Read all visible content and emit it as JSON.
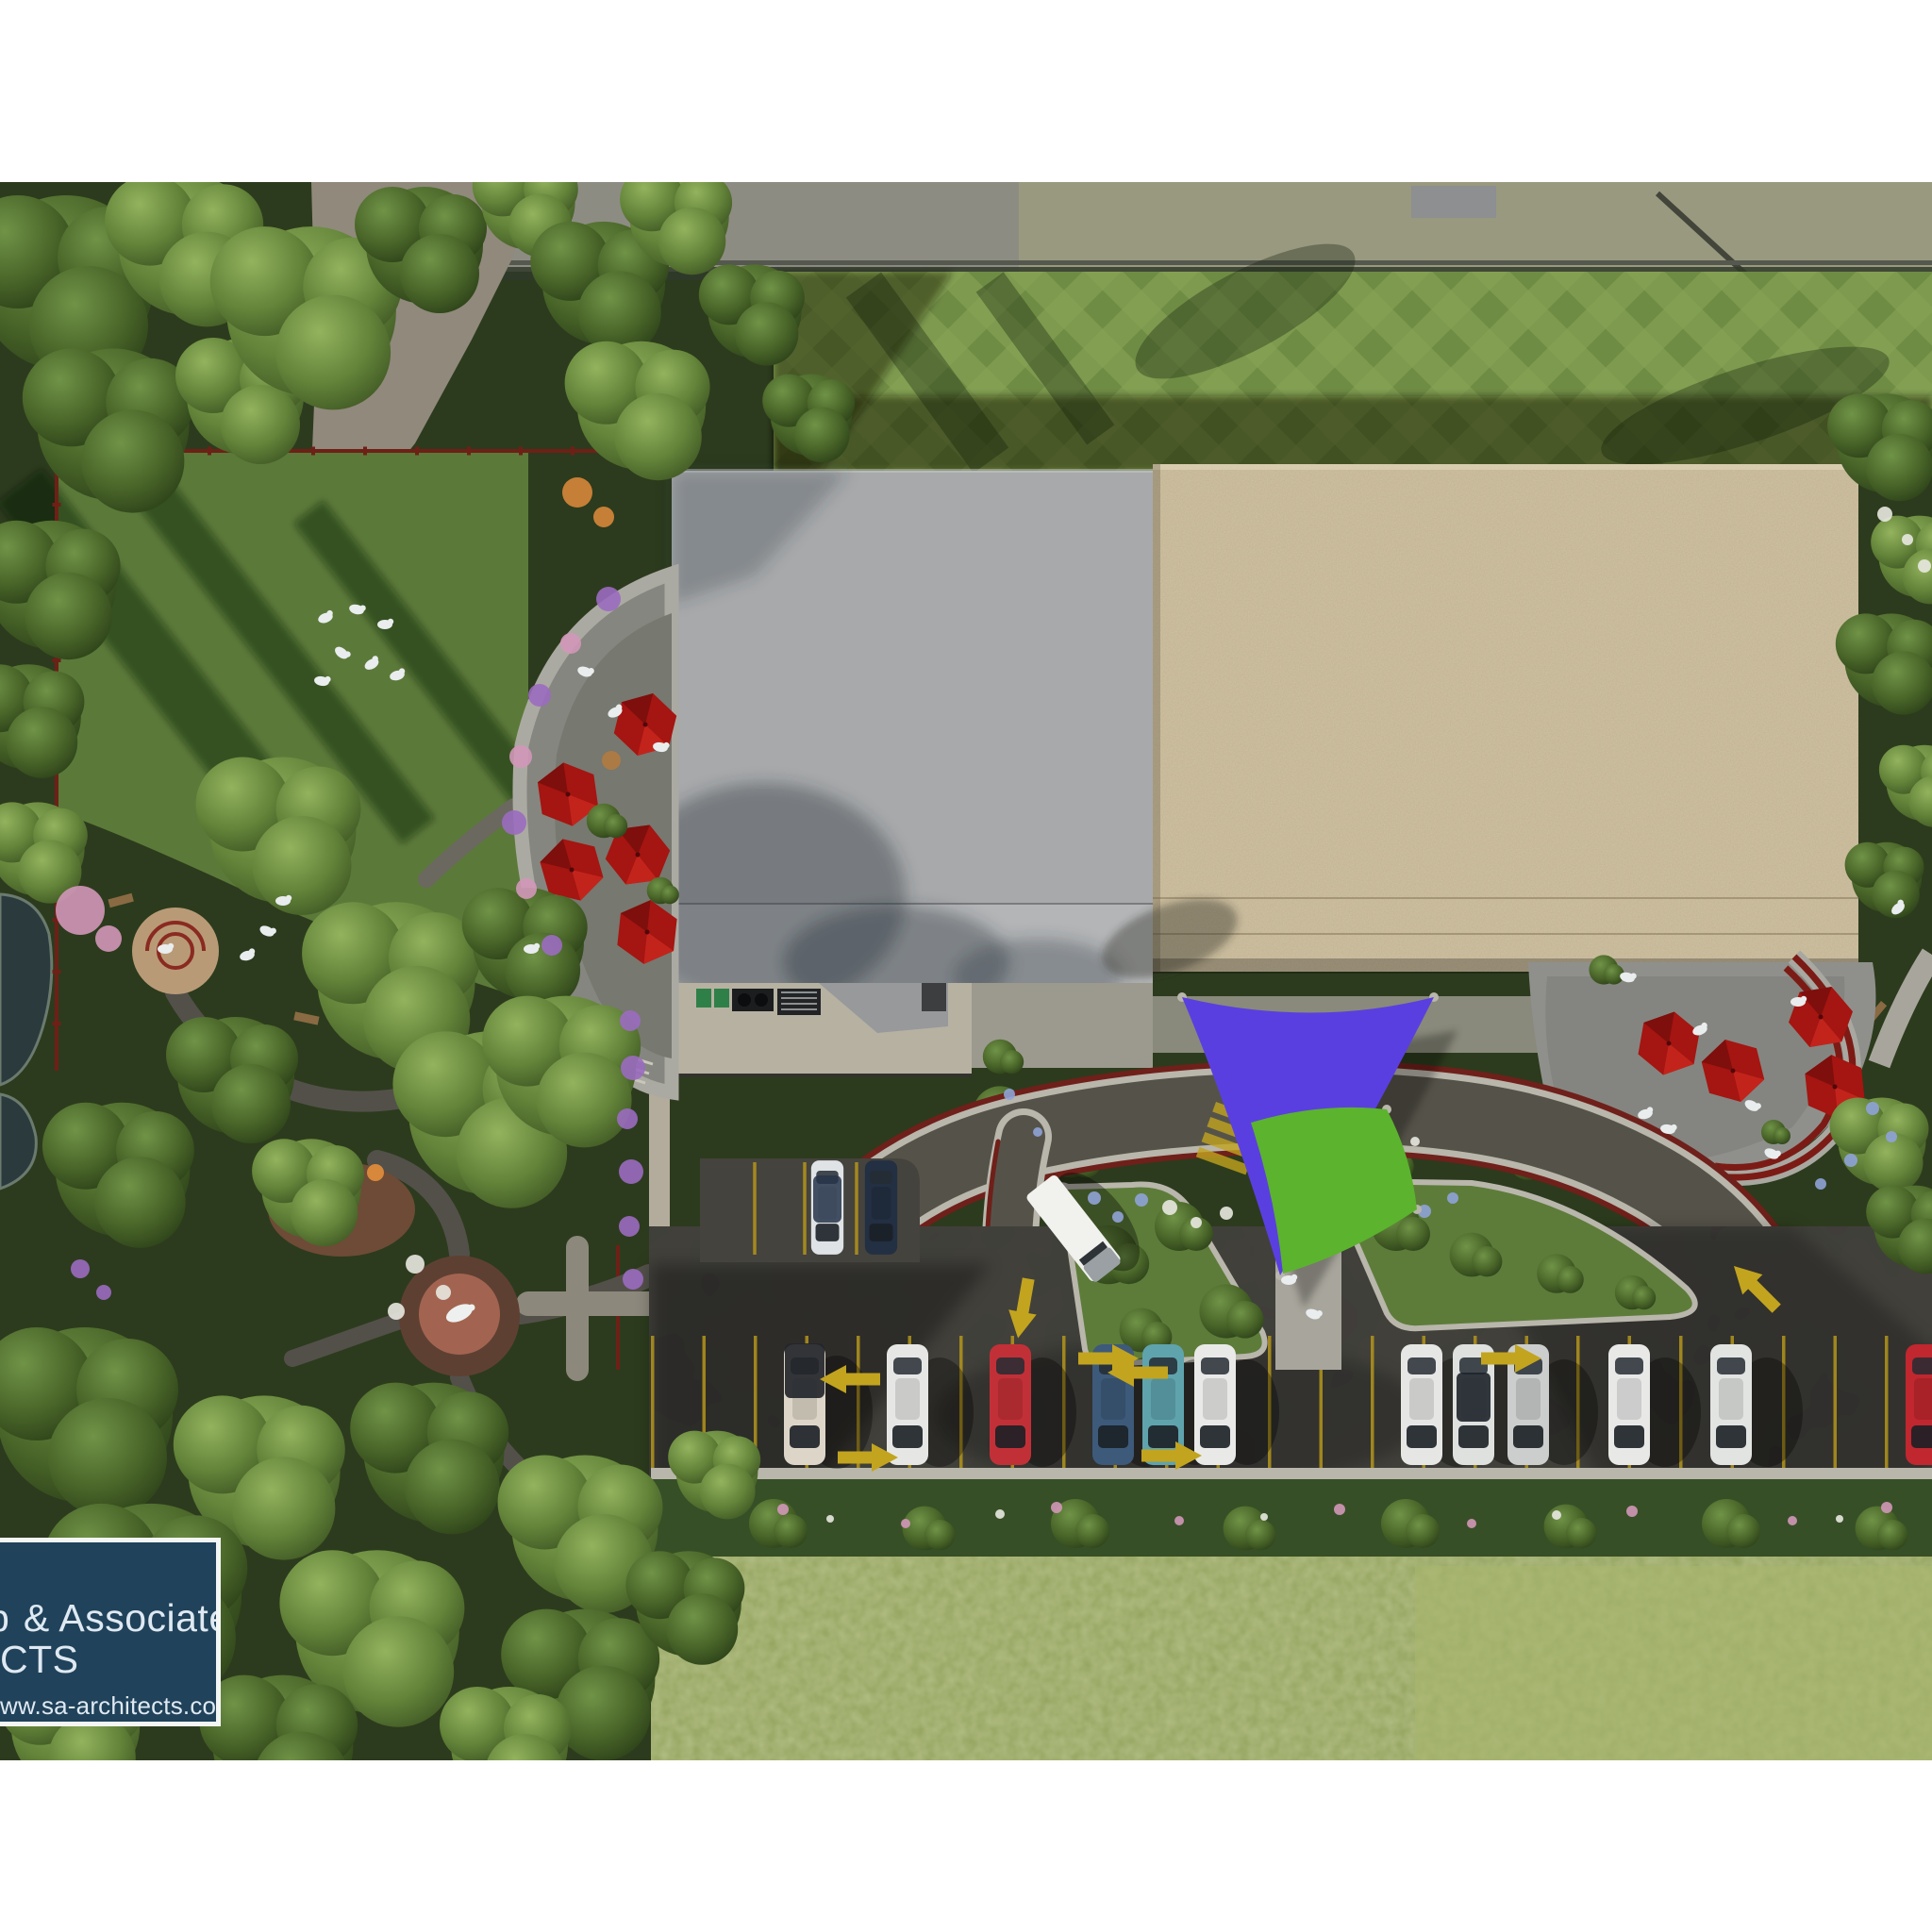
{
  "logo": {
    "line1_partial": "b",
    "line1": " & Associates",
    "line2": "CTS",
    "line3": "ww.sa-architects.com"
  },
  "colors": {
    "page_bg": "#ffffff",
    "forest_dark": "#2c3b1d",
    "lawn_green": "#5b7a39",
    "plaid_base": "#7d9a4e",
    "dirt": "#90897c",
    "top_road": "#8d8c83",
    "verge": "#9a9a7e",
    "roof_grey": "#a7a9ab",
    "roof_grey_light": "#b3b5b7",
    "roof_beige": "#cfc1a2",
    "service_pad": "#b7b1a2",
    "patio_light": "#8f908c",
    "patio_dark": "#77786f",
    "trellis_red": "#7c1b15",
    "umbrella_red": "#a51511",
    "asphalt": "#403e39",
    "road_asphalt": "#555349",
    "curb": "#b9b6ac",
    "curb_red": "#6f201a",
    "paint_yellow": "#c2a41f",
    "stall_yellow": "#b3951b",
    "island_grass": "#5d7c3a",
    "sail_purple": "#5a3fe0",
    "sail_green": "#5cb32e",
    "pond": "#2b3a3d",
    "sand": "#b99a77",
    "brick_outer": "#5e4033",
    "brick_inner": "#a26450",
    "play_base": "#6e4b36",
    "hedge": "#374f26",
    "meadow": "#93a35c",
    "meadow_light": "#a8b76d",
    "flower_pink": "#d297b8",
    "flower_purple": "#9b6cc0",
    "flower_white": "#e8e8e0",
    "flower_blue": "#8fa3d8",
    "flower_orange": "#d8883a",
    "people_white": "#e9edee",
    "truck_white": "#f1f1ee",
    "logo_panel": "#20425a",
    "logo_border": "#f4f6f5",
    "logo_text": "#dfe9f2"
  },
  "scene": {
    "description_cars_bottom_row": [
      {
        "hex": "#ddd6c8",
        "name": "white pickup with dark canopy"
      },
      {
        "hex": "#e6e7e5",
        "name": "white sedan"
      },
      {
        "hex": "#c23037",
        "name": "red hatchback"
      },
      {
        "hex": "#3d5a7a",
        "name": "steel blue sedan"
      },
      {
        "hex": "#5fa3ad",
        "name": "teal sedan"
      },
      {
        "hex": "#e9eae8",
        "name": "white sedan"
      },
      {
        "hex": "#e6e7e5",
        "name": "white sedan"
      },
      {
        "hex": "#dfe1df",
        "name": "white sedan with dark roof"
      },
      {
        "hex": "#cbcecd",
        "name": "silver sedan"
      },
      {
        "hex": "#e8e9e7",
        "name": "white sedan"
      },
      {
        "hex": "#e2e4e2",
        "name": "white sedan"
      },
      {
        "hex": "#c0272e",
        "name": "red sedan at image edge"
      }
    ],
    "cars_pad": [
      {
        "hex": "#dfe3e6",
        "name": "white sedan dark glass"
      },
      {
        "hex": "#232f42",
        "name": "navy sedan"
      }
    ],
    "umbrellas": {
      "left_patio": 5,
      "right_patio": 4,
      "canopy_color": "#a51511"
    },
    "shade_sails": [
      {
        "color": "#5a3fe0",
        "shape": "triangle"
      },
      {
        "color": "#5cb32e",
        "shape": "quad"
      }
    ],
    "truck": {
      "hex": "#f1f1ee",
      "name": "white box truck at drop-off"
    },
    "arrows": [
      "right",
      "right",
      "right",
      "right",
      "left",
      "left",
      "up-left",
      "down"
    ]
  }
}
